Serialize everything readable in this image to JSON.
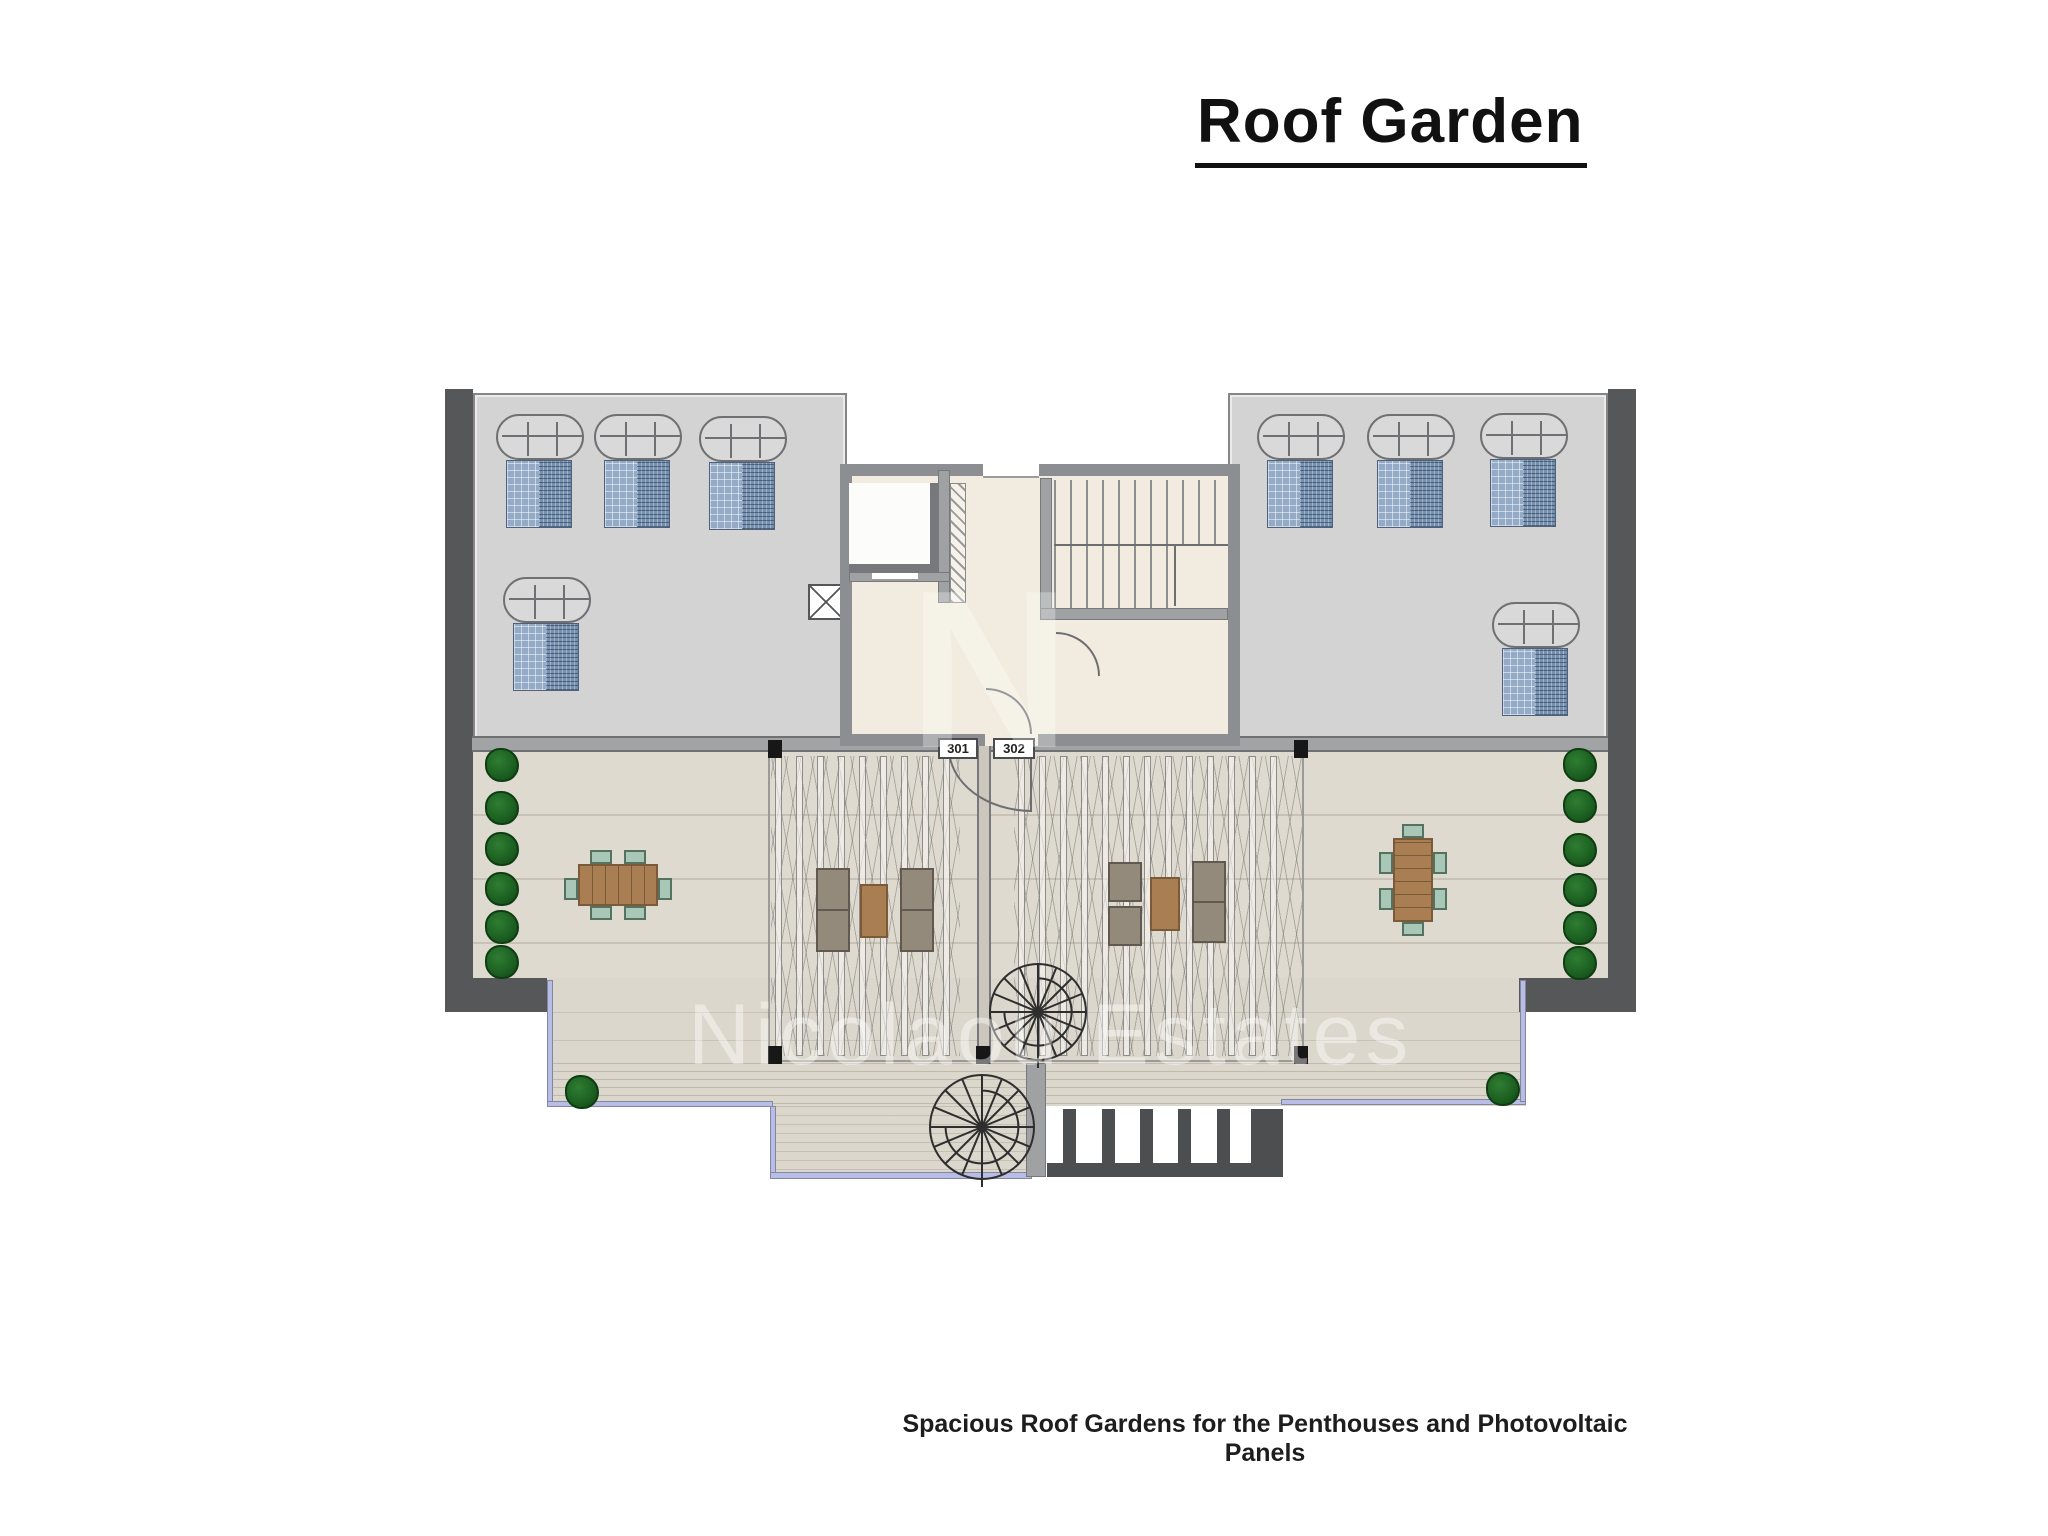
{
  "title": "Roof Garden",
  "caption": "Spacious Roof Gardens for the Penthouses and Photovoltaic Panels",
  "units": [
    {
      "label": "301"
    },
    {
      "label": "302"
    }
  ],
  "watermark": "Nicolaou Estates",
  "plan": {
    "areas": {
      "roof": "photovoltaic panel roof",
      "terrace": "penthouse roof gardens",
      "core": "stair and lift core"
    },
    "colors": {
      "roof_gray": "#d2d3d2",
      "wall_dark": "#565759",
      "core_floor": "#f1ecdf",
      "terrace_floor": "#dfdacf",
      "railing_blue": "#b7bde7",
      "panel_blue_light": "#93abc6",
      "panel_blue_dark": "#7490ae",
      "plant_green": "#1b5e20",
      "wood_brown": "#a97e52",
      "chair_teal": "#a9c7b6"
    }
  }
}
